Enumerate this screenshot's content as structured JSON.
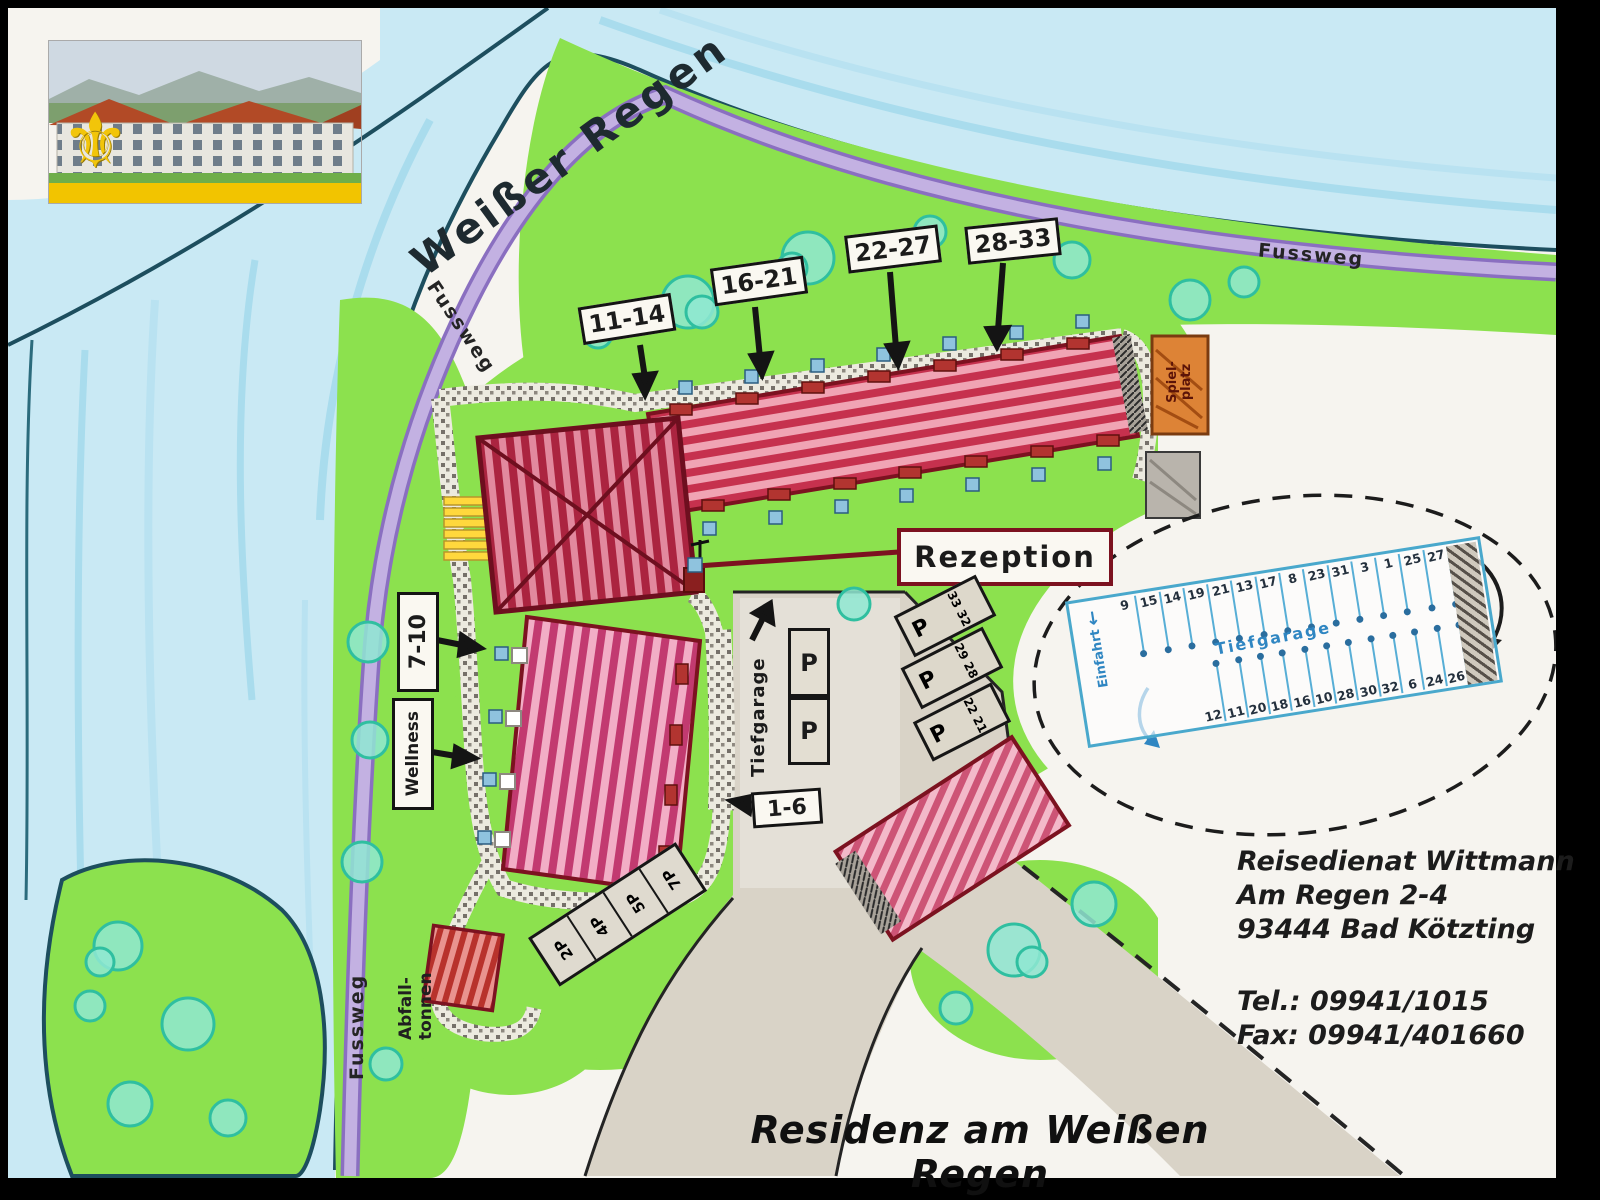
{
  "header": {
    "fleur_icon": "⚜"
  },
  "map": {
    "river_label": "Weißer Regen",
    "footpath_labels": {
      "top": "Fussweg",
      "right": "Fussweg",
      "left": "Fussweg"
    },
    "unit_signs": {
      "s11_14": "11-14",
      "s16_21": "16-21",
      "s22_27": "22-27",
      "s28_33": "28-33",
      "s7_10": "7-10",
      "s1_6": "1-6"
    },
    "wellness": "Wellness",
    "reception": "Rezeption",
    "waste_line1": "Abfall-",
    "waste_line2": "tonnen",
    "playground_line1": "Spiel-",
    "playground_line2": "platz",
    "tiefgarage_ramp": "Tiefgarage",
    "p": "P",
    "outdoor_p": [
      {
        "p": "P",
        "num1": "33",
        "num2": "32"
      },
      {
        "p": "P",
        "num1": "29",
        "num2": "28"
      },
      {
        "p": "P",
        "num1": "22",
        "num2": "21"
      }
    ],
    "stalls": [
      "2P",
      "4P",
      "5P",
      "7P"
    ]
  },
  "garage": {
    "label": "Tiefgarage",
    "entry": "Einfahrt",
    "entry_arrow": "↓",
    "top_row": [
      "9",
      "15",
      "14",
      "19",
      "21",
      "13",
      "17",
      "8",
      "23",
      "31",
      "3",
      "1",
      "25",
      "27"
    ],
    "bottom_row": [
      "12",
      "11",
      "20",
      "18",
      "16",
      "10",
      "28",
      "30",
      "32",
      "6",
      "24",
      "26"
    ]
  },
  "contact": {
    "company": "Reisedienat Wittmann",
    "street": "Am Regen 2-4",
    "city": "93444 Bad Kötzting",
    "tel": "Tel.: 09941/1015",
    "fax": "Fax: 09941/401660"
  },
  "footer": {
    "title": "Residenz am Weißen Regen"
  },
  "colors": {
    "water": "#c9e9f4",
    "grass": "#8ce14e",
    "path_purple": "#c3b1e2",
    "building_red": "#c6314e",
    "garage_blue": "#4aa5cf",
    "road_gray": "#d9d3c7",
    "accent_dark_red": "#7c1220",
    "logo_yellow": "#f2c400"
  }
}
